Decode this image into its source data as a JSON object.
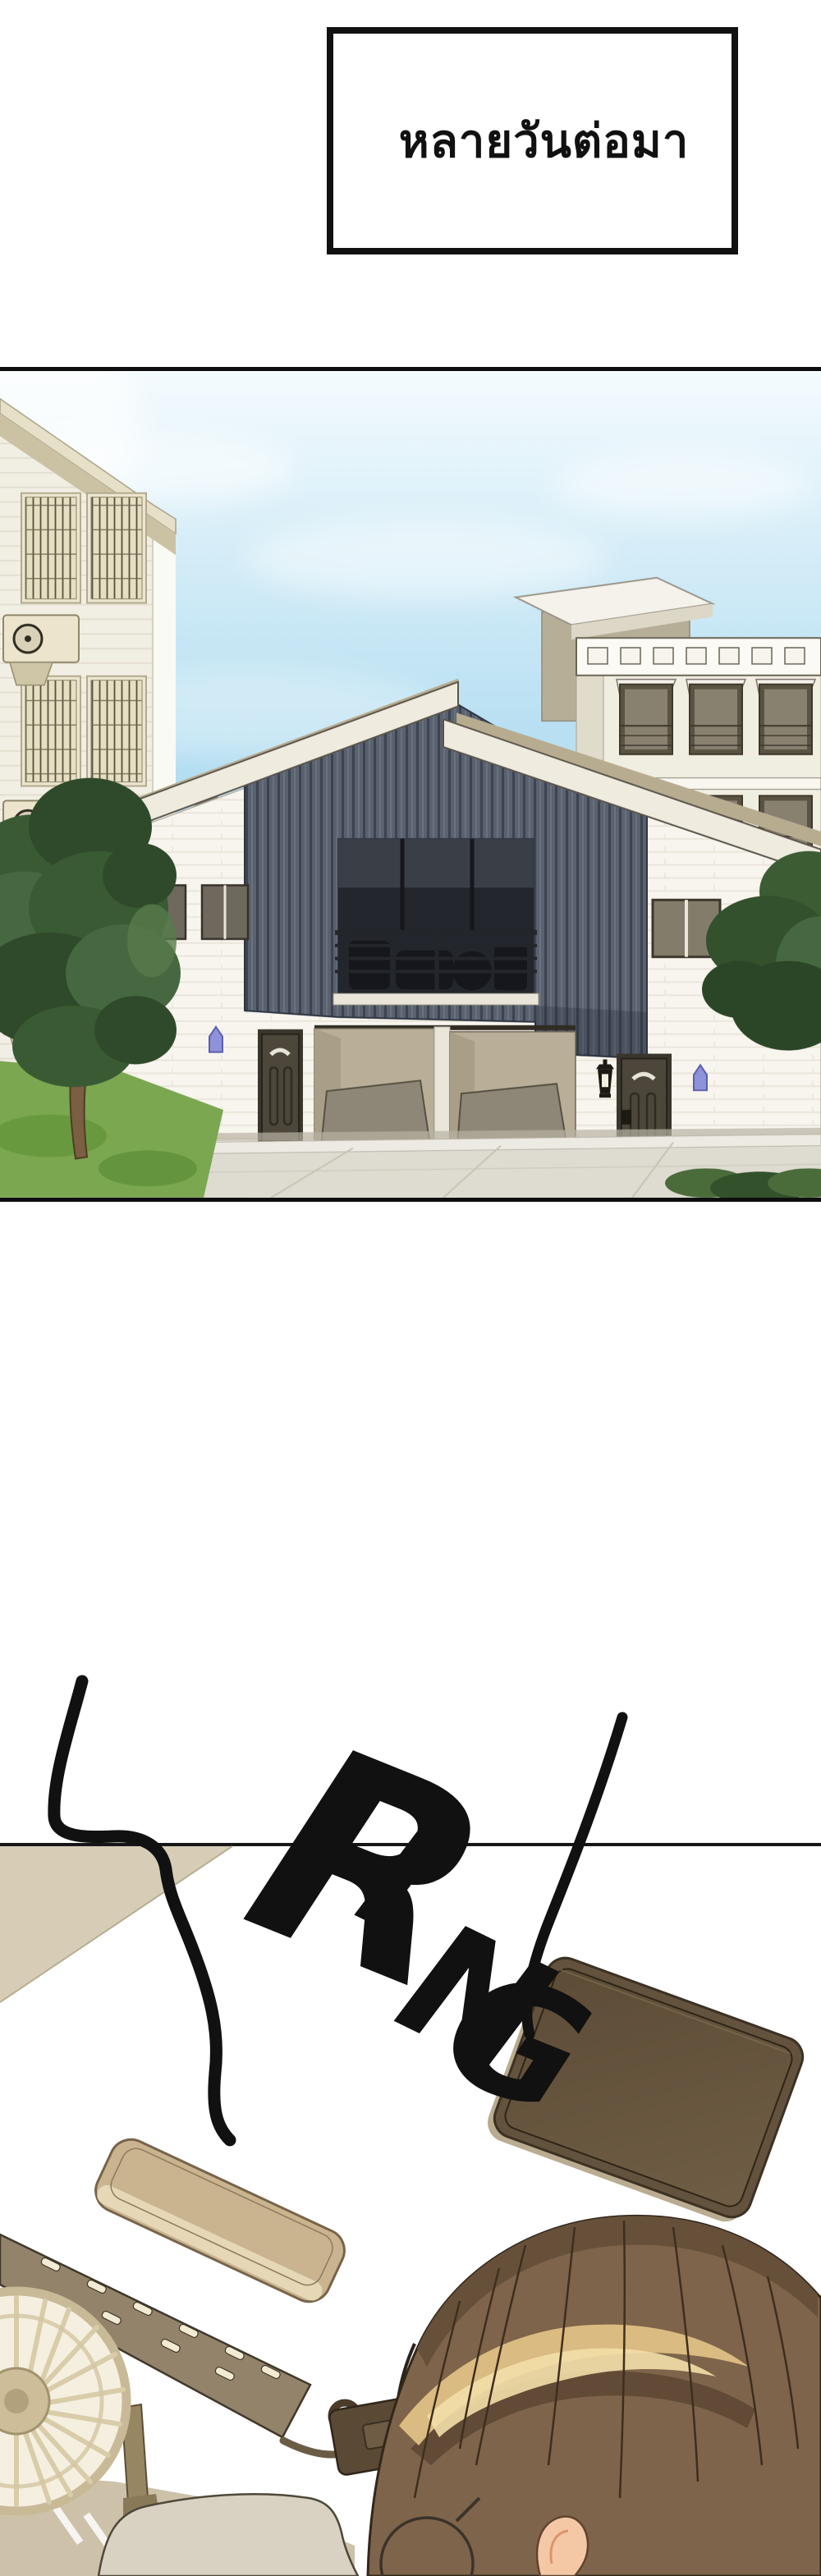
{
  "caption": {
    "text": "หลายวันต่อมา"
  },
  "sfx": {
    "text": "RING",
    "letters": [
      "R",
      "I",
      "N",
      "G"
    ]
  },
  "colors": {
    "page_background": "#ffffff",
    "panel_border": "#0e0e0e",
    "sky_blue": "#b2ddf1",
    "duplex_wood_panel": "#5a6270",
    "duplex_brick_white": "#f7f5ee",
    "apartment_cornice_cream": "#d8d0b4",
    "address_plaque_purple": "#8d92da",
    "grass_green": "#7aa750",
    "tree_foliage_green": "#3a5a34",
    "driveway_gray": "#dedbd1",
    "desk_wall_beige": "#d7cdb7",
    "device_tan": "#c9b48f",
    "power_strip_tan": "#92836a",
    "tablet_brown": "#63523d",
    "hair_brown": "#7e644a",
    "hair_highlight_gold": "#f2dfa8",
    "ear_skin": "#f5c8a5",
    "sfx_ink": "#111111"
  }
}
